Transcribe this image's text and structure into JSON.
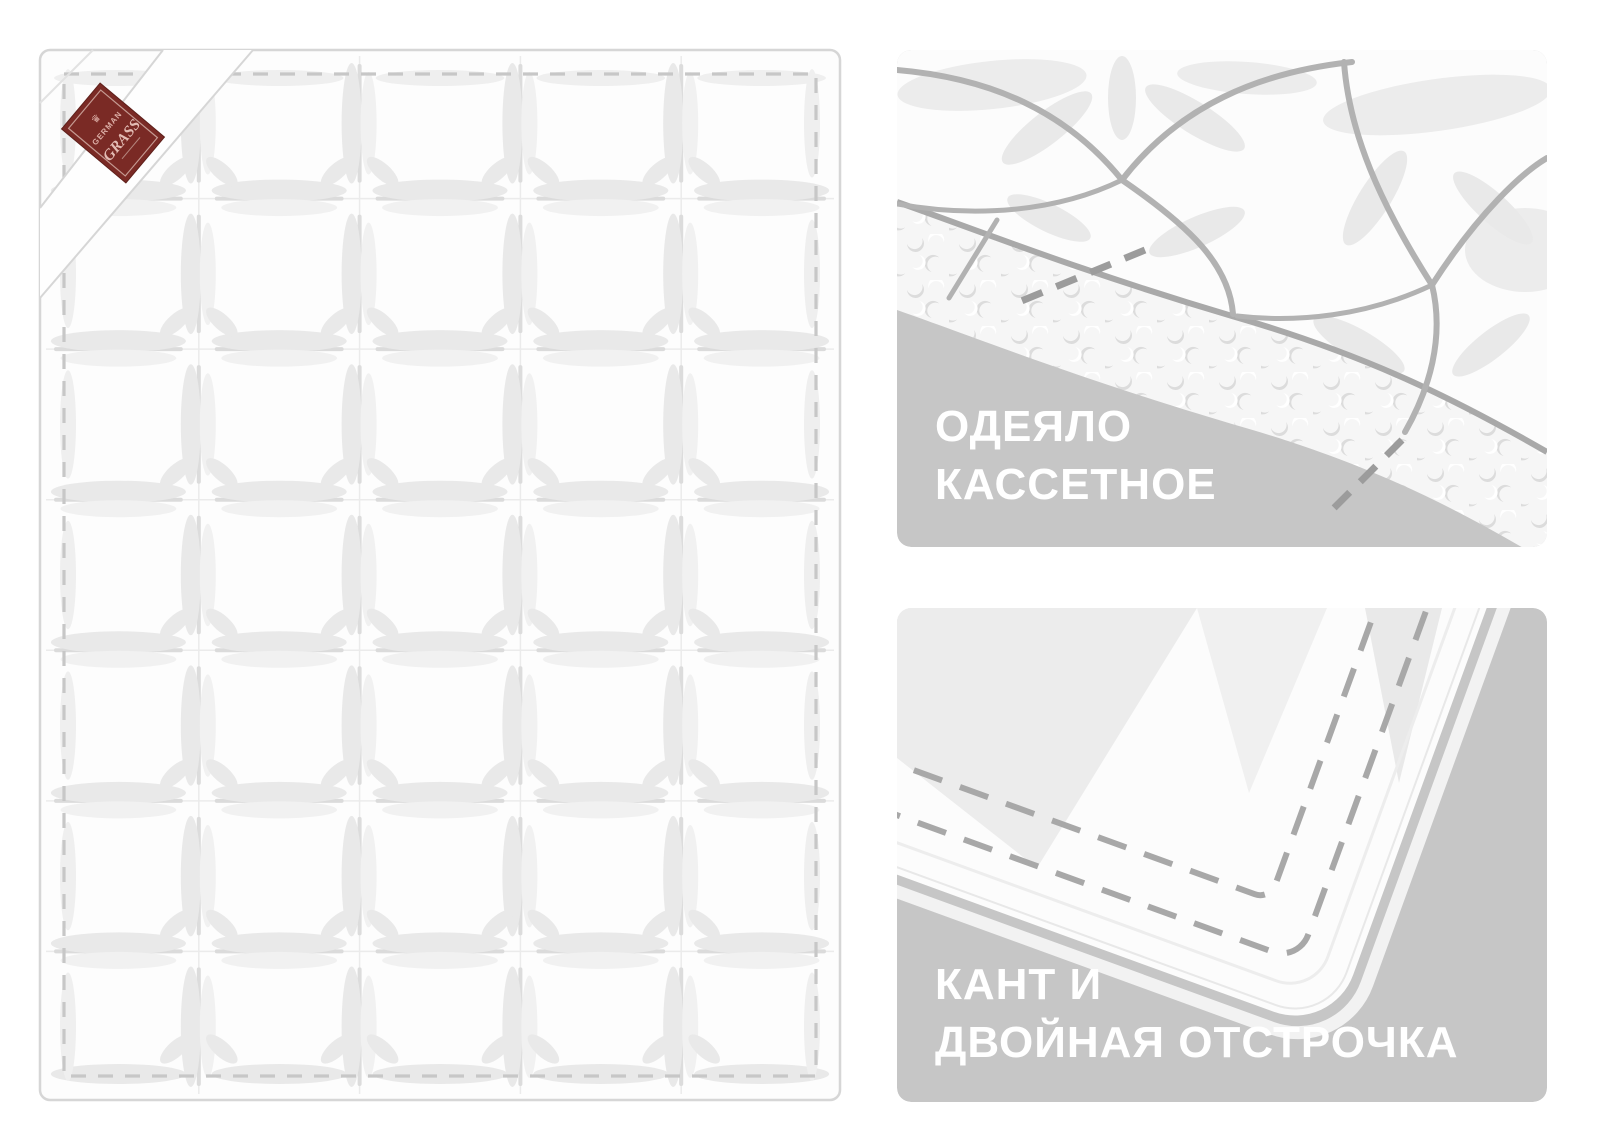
{
  "blanket": {
    "columns": 5,
    "rows": 7,
    "tag": {
      "crown": "♛",
      "line1": "GERMAN",
      "line2": "GRASS"
    }
  },
  "panels": {
    "cassette": {
      "line1": "ОДЕЯЛО",
      "line2": "КАССЕТНОЕ"
    },
    "piping": {
      "line1": "КАНТ И",
      "line2": "ДВОЙНАЯ ОТСТРОЧКА"
    }
  },
  "colors": {
    "panel_background": "#c6c6c6",
    "caption_text": "#ffffff",
    "quilt_white": "#fcfcfc",
    "seam_line": "#a9a9a9",
    "stitch_dash": "#9c9c9c",
    "blanket_outline": "#d6d6d6",
    "blanket_hairline": "#ebebeb",
    "blanket_dash": "#c7c7c7",
    "lens_fill": "#e9e9e9",
    "lens_fill_light": "#f1f1f1",
    "lens_shadow": "#dbdbdb",
    "tag_background": "#7a2a25",
    "tag_border": "#c59a92",
    "tag_text": "#dcaea6"
  }
}
